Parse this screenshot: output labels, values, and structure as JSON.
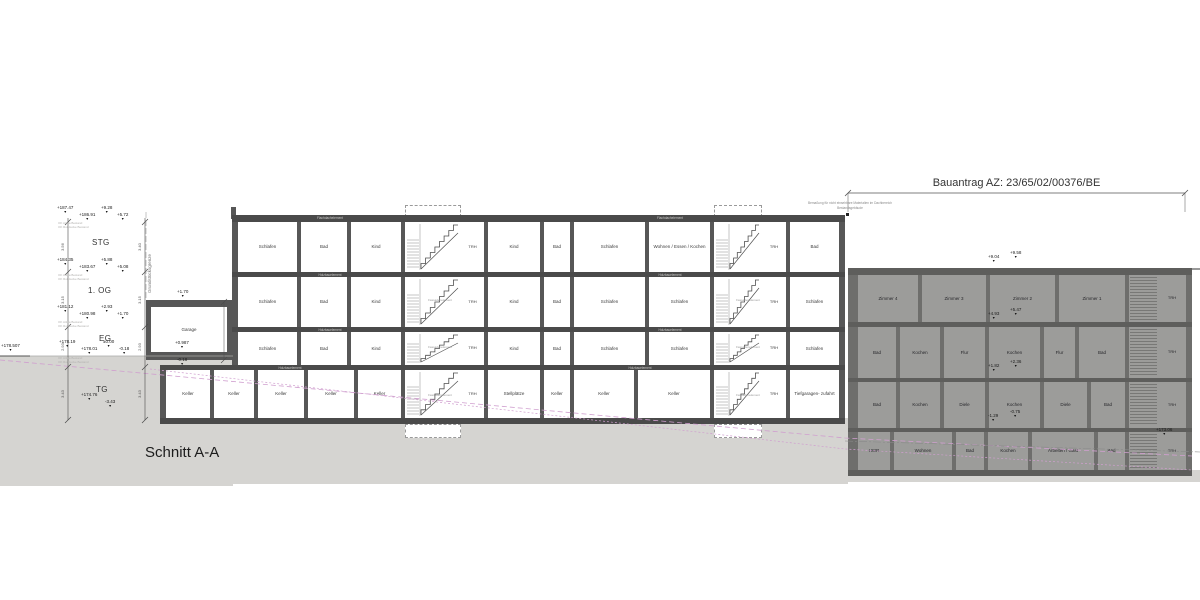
{
  "title": "Schnitt A-A",
  "dimension_header": {
    "label": "Bauantrag AZ: 23/65/02/00376/BE",
    "note_line1": "Bemaßung für nicht einsehbare Materialien im Dachbereich",
    "note_line2": "Bestandsgebäude"
  },
  "left_annotations": {
    "floor_labels": [
      "STG",
      "1. OG",
      "EG",
      "TG"
    ],
    "markers": [
      "+187.47",
      "+186.91",
      "+9.28",
      "+5.72",
      "+184.35",
      "+183.67",
      "+5.88",
      "+5.08",
      "+181.12",
      "+180.98",
      "+2.93",
      "+1.70",
      "+178.19",
      "+178.01",
      "±0.00",
      "-0.18",
      "+174.76",
      "-3.43"
    ],
    "ground_marker": "+178.507",
    "boundary_label": "Grundstücksgrenze",
    "dim_chain_1": [
      "3.56",
      "3.15",
      "2.93",
      "3.43"
    ],
    "dim_chain_2": [
      "3.40",
      "3.15",
      "2.93",
      "3.43"
    ],
    "sub_annotations": [
      "OK Attika Bestand",
      "OK Rohdecke Bestand"
    ]
  },
  "garage": {
    "label": "Garage",
    "markers": [
      "+1.70",
      "+0.987",
      "-0.18"
    ]
  },
  "main_building": {
    "slab_labels": {
      "roof": "Flachdachelement",
      "floor": "Holzbauelement",
      "stair": "Fassadenelement"
    },
    "floors": [
      {
        "cells": [
          {
            "t": "room",
            "label": "Schlafen"
          },
          {
            "t": "room",
            "label": "Bad"
          },
          {
            "t": "room",
            "label": "Kind"
          },
          {
            "t": "stair"
          },
          {
            "t": "trh",
            "label": "TRH"
          },
          {
            "t": "room",
            "label": "Kind"
          },
          {
            "t": "room",
            "label": "Bad"
          },
          {
            "t": "room",
            "label": "Schlafen"
          },
          {
            "t": "room",
            "label": "Wohnen / Essen / Kochen"
          },
          {
            "t": "stair"
          },
          {
            "t": "trh",
            "label": "TRH"
          },
          {
            "t": "room",
            "label": "Bad"
          }
        ]
      },
      {
        "cells": [
          {
            "t": "room",
            "label": "Schlafen"
          },
          {
            "t": "room",
            "label": "Bad"
          },
          {
            "t": "room",
            "label": "Kind"
          },
          {
            "t": "stair"
          },
          {
            "t": "trh",
            "label": "TRH"
          },
          {
            "t": "room",
            "label": "Kind"
          },
          {
            "t": "room",
            "label": "Bad"
          },
          {
            "t": "room",
            "label": "Schlafen"
          },
          {
            "t": "room",
            "label": "Schlafen"
          },
          {
            "t": "stair"
          },
          {
            "t": "trh",
            "label": "TRH"
          },
          {
            "t": "room",
            "label": "Schlafen"
          }
        ]
      },
      {
        "cells": [
          {
            "t": "room",
            "label": "Schlafen"
          },
          {
            "t": "room",
            "label": "Bad"
          },
          {
            "t": "room",
            "label": "Kind"
          },
          {
            "t": "stair"
          },
          {
            "t": "trh",
            "label": "TRH"
          },
          {
            "t": "room",
            "label": "Kind"
          },
          {
            "t": "room",
            "label": "Bad"
          },
          {
            "t": "room",
            "label": "Schlafen"
          },
          {
            "t": "room",
            "label": "Schlafen"
          },
          {
            "t": "stair"
          },
          {
            "t": "trh",
            "label": "TRH"
          },
          {
            "t": "room",
            "label": "Schlafen"
          }
        ]
      },
      {
        "cells": [
          {
            "t": "room",
            "label": "Keller"
          },
          {
            "t": "room",
            "label": "Keller"
          },
          {
            "t": "room",
            "label": "Keller"
          },
          {
            "t": "room",
            "label": "Keller"
          },
          {
            "t": "room",
            "label": "Keller"
          },
          {
            "t": "stair"
          },
          {
            "t": "trh",
            "label": "TRH"
          },
          {
            "t": "room",
            "label": "Stellplätze"
          },
          {
            "t": "room",
            "label": "Keller"
          },
          {
            "t": "room",
            "label": "Keller"
          },
          {
            "t": "room",
            "label": "Keller"
          },
          {
            "t": "stair"
          },
          {
            "t": "trh",
            "label": "TRH"
          },
          {
            "t": "room",
            "label": "Tiefgaragen- zufahrt"
          }
        ]
      }
    ]
  },
  "dark_building": {
    "rows": [
      {
        "rooms": [
          "Zimmer 4",
          "Zimmer 3",
          "Zimmer 2",
          "Zimmer 1"
        ],
        "trh": "TRH"
      },
      {
        "rooms": [
          "Bad",
          "Kochen",
          "Flur",
          "Kochen",
          "Flur",
          "Bad"
        ],
        "trh": "TRH"
      },
      {
        "rooms": [
          "Bad",
          "Kochen",
          "Diele",
          "Kochen",
          "Diele",
          "Bad"
        ],
        "trh": "TRH"
      },
      {
        "rooms": [
          "HWR",
          "Wohnen",
          "Bad",
          "Kochen",
          "Arbeiten / Gast",
          "Bad"
        ],
        "trh": "TRH"
      }
    ],
    "markers": [
      "+9.04",
      "+9.58",
      "+4.93",
      "+5.47",
      "+1.82",
      "+2.36",
      "-1.29",
      "-0.75",
      "+173.06"
    ]
  }
}
